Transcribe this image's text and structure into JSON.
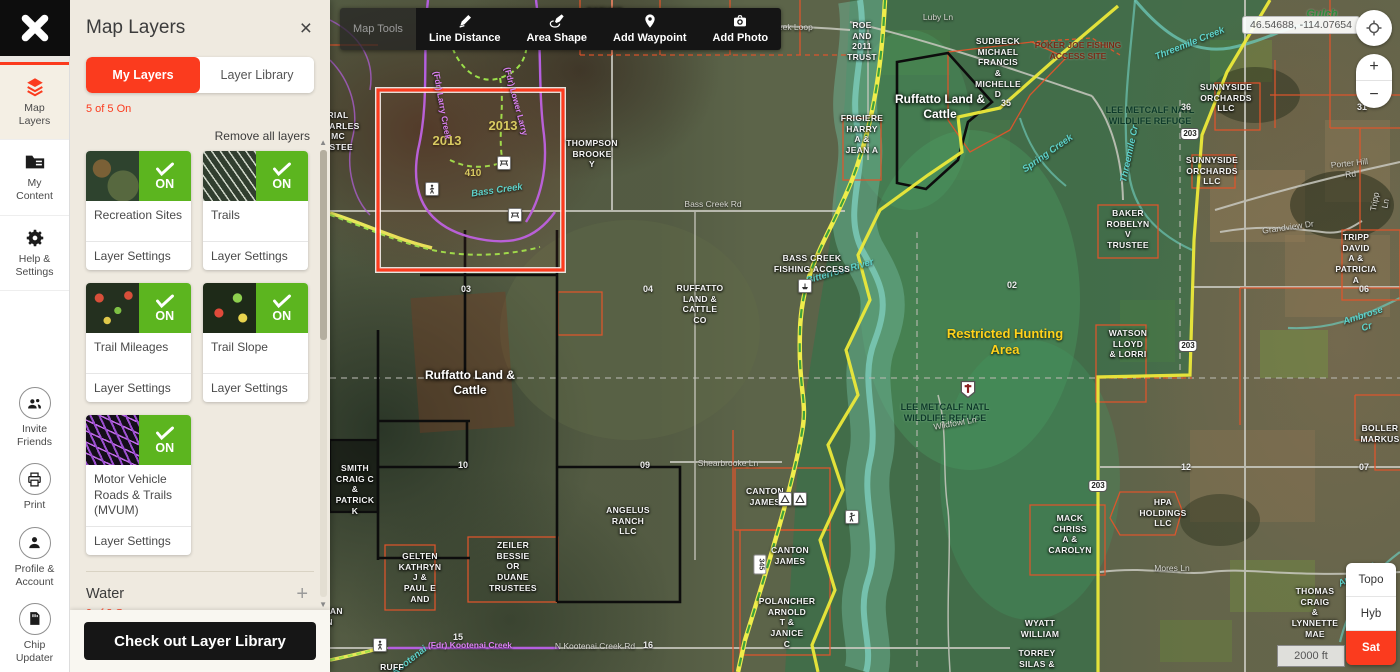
{
  "sidebar": {
    "items": [
      {
        "label": "Map\nLayers",
        "icon": "map-layers-icon",
        "active": true
      },
      {
        "label": "My\nContent",
        "icon": "folder-icon",
        "active": false
      },
      {
        "label": "Help &\nSettings",
        "icon": "gear-icon",
        "active": false
      },
      {
        "label": "Invite\nFriends",
        "icon": "people-icon",
        "active": false
      },
      {
        "label": "Print",
        "icon": "printer-icon",
        "active": false
      },
      {
        "label": "Profile &\nAccount",
        "icon": "person-icon",
        "active": false
      },
      {
        "label": "Chip\nUpdater",
        "icon": "chip-icon",
        "active": false
      }
    ]
  },
  "panel": {
    "title": "Map Layers",
    "close_label": "×",
    "tabs": [
      {
        "label": "My Layers"
      },
      {
        "label": "Layer Library"
      }
    ],
    "status": "5 of 5 On",
    "remove_all": "Remove all layers",
    "cards": [
      {
        "name": "Recreation Sites",
        "status": "ON",
        "settings": "Layer Settings"
      },
      {
        "name": "Trails",
        "status": "ON",
        "settings": "Layer Settings"
      },
      {
        "name": "Trail Mileages",
        "status": "ON",
        "settings": "Layer Settings"
      },
      {
        "name": "Trail Slope",
        "status": "ON",
        "settings": "Layer Settings"
      },
      {
        "name": "Motor Vehicle Roads & Trails (MVUM)",
        "status": "ON",
        "settings": "Layer Settings"
      }
    ],
    "water": {
      "title": "Water",
      "status": "0 of 3 On",
      "add": "+"
    },
    "cta": "Check out Layer Library"
  },
  "map_tools": {
    "title": "Map Tools",
    "buttons": [
      {
        "label": "Line Distance",
        "icon": "pencil-line-icon"
      },
      {
        "label": "Area Shape",
        "icon": "pencil-shape-icon"
      },
      {
        "label": "Add Waypoint",
        "icon": "map-pin-icon"
      },
      {
        "label": "Add Photo",
        "icon": "camera-icon"
      }
    ]
  },
  "controls": {
    "coordinates": "46.54688, -114.07654",
    "zoom_in": "+",
    "zoom_out": "−",
    "scale": "2000 ft",
    "basemaps": [
      {
        "label": "Topo",
        "active": false
      },
      {
        "label": "Hyb",
        "active": false
      },
      {
        "label": "Sat",
        "active": true
      }
    ]
  },
  "map_labels": [
    {
      "t": "ESTHER",
      "c": "owner",
      "x": 275,
      "y": 6
    },
    {
      "t": "Larry Creek Loop",
      "c": "road",
      "x": 450,
      "y": 22
    },
    {
      "t": "Luby Ln",
      "c": "road",
      "x": 608,
      "y": 12
    },
    {
      "t": "ROE\nAND\n2011\nTRUST",
      "c": "owner",
      "x": 532,
      "y": 20
    },
    {
      "t": "SUDBECK\nMICHAEL\nFRANCIS\n&\nMICHELLE\nD",
      "c": "owner",
      "x": 668,
      "y": 36
    },
    {
      "t": "POKER JOE FISHING\nACCESS SITE",
      "c": "poi-dark",
      "x": 748,
      "y": 40
    },
    {
      "t": "Ruffatto Land &\nCattle",
      "c": "owner-lg",
      "x": 610,
      "y": 92
    },
    {
      "t": "LEE METCALF NATL\nWILDLIFE REFUGE",
      "c": "forest",
      "x": 820,
      "y": 105
    },
    {
      "t": "SUNNYSIDE\nORCHARDS\nLLC",
      "c": "owner",
      "x": 896,
      "y": 82
    },
    {
      "t": "SUNNYSIDE\nORCHARDS\nLLC",
      "c": "owner",
      "x": 882,
      "y": 155
    },
    {
      "t": "BAKER\nROBELYN\nV\nTRUSTEE",
      "c": "owner",
      "x": 798,
      "y": 208
    },
    {
      "t": "TRIPP\nDAVID\nA &\nPATRICIA\nA",
      "c": "owner",
      "x": 1026,
      "y": 232
    },
    {
      "t": "THOMPSON\nBROOKE\nY",
      "c": "owner",
      "x": 262,
      "y": 138
    },
    {
      "t": "FRIGIERE\nHARRY\nA &\nJEAN A",
      "c": "owner",
      "x": 532,
      "y": 113
    },
    {
      "t": "RIAL\nCHARLES\nMC\nUSTEE",
      "c": "owner",
      "x": 8,
      "y": 110
    },
    {
      "t": "2013",
      "c": "year",
      "x": 117,
      "y": 133
    },
    {
      "t": "2013",
      "c": "year",
      "x": 173,
      "y": 118
    },
    {
      "t": "410",
      "c": "year",
      "x": 143,
      "y": 168,
      "fs": 10
    },
    {
      "t": "Bass Creek",
      "c": "water",
      "x": 167,
      "y": 185,
      "r": -8
    },
    {
      "t": "(Fdr) Larry Creek",
      "c": "purple",
      "x": 112,
      "y": 100,
      "r": 80
    },
    {
      "t": "(Fdr) Lower Larry",
      "c": "purple",
      "x": 186,
      "y": 96,
      "r": 75
    },
    {
      "t": "Bass Creek Rd",
      "c": "road",
      "x": 383,
      "y": 199
    },
    {
      "t": "RUFFATTO\nLAND &\nCATTLE\nCO",
      "c": "owner",
      "x": 370,
      "y": 283
    },
    {
      "t": "04",
      "c": "section",
      "x": 318,
      "y": 284
    },
    {
      "t": "03",
      "c": "section",
      "x": 136,
      "y": 284
    },
    {
      "t": "Ruffatto Land &\nCattle",
      "c": "owner-lg",
      "x": 140,
      "y": 368
    },
    {
      "t": "SMITH\nCRAIG C\n&\nPATRICK\nK",
      "c": "owner",
      "x": 25,
      "y": 463
    },
    {
      "t": "GELTEN\nKATHRYN\nJ &\nPAUL E\nAND",
      "c": "owner",
      "x": 90,
      "y": 551
    },
    {
      "t": "CHAPMAN\nOREN",
      "c": "owner",
      "x": -10,
      "y": 606
    },
    {
      "t": "ZEILER\nBESSIE\nOR\nDUANE\nTRUSTEES",
      "c": "owner",
      "x": 183,
      "y": 540
    },
    {
      "t": "ANGELUS\nRANCH\nLLC",
      "c": "owner",
      "x": 298,
      "y": 505
    },
    {
      "t": "CANTON\nJAMES",
      "c": "owner",
      "x": 435,
      "y": 486
    },
    {
      "t": "CANTON\nJAMES",
      "c": "owner",
      "x": 460,
      "y": 545
    },
    {
      "t": "POLANCHER\nARNOLD\nT &\nJANICE\nC",
      "c": "owner",
      "x": 457,
      "y": 596
    },
    {
      "t": "TORREY\nSILAS &",
      "c": "owner",
      "x": 707,
      "y": 648
    },
    {
      "t": "WYATT\nWILLIAM",
      "c": "owner",
      "x": 710,
      "y": 618
    },
    {
      "t": "Shearbrooke Ln",
      "c": "road",
      "x": 398,
      "y": 458
    },
    {
      "t": "(Fdr) Kootenai Creek",
      "c": "purple",
      "x": 140,
      "y": 640
    },
    {
      "t": "N Kootenai Creek Rd",
      "c": "road",
      "x": 265,
      "y": 641
    },
    {
      "t": "Kootenai",
      "c": "water",
      "x": 80,
      "y": 655,
      "r": -38
    },
    {
      "t": "RUFF",
      "c": "owner",
      "x": 62,
      "y": 662
    },
    {
      "t": "Bitterroot  River",
      "c": "water",
      "x": 510,
      "y": 266,
      "r": -16
    },
    {
      "t": "BASS CREEK\nFISHING ACCESS",
      "c": "owner",
      "x": 482,
      "y": 253
    },
    {
      "t": "Restricted Hunting\nArea",
      "c": "restrict",
      "x": 675,
      "y": 326
    },
    {
      "t": "02",
      "c": "section",
      "x": 682,
      "y": 280
    },
    {
      "t": "LEE METCALF NATL\nWILDLIFE REFUGE",
      "c": "forest",
      "x": 615,
      "y": 402
    },
    {
      "t": "Wildfowl Ln",
      "c": "road",
      "x": 625,
      "y": 418,
      "r": -10
    },
    {
      "t": "WATSON\nLLOYD\n& LORRI",
      "c": "owner",
      "x": 798,
      "y": 328
    },
    {
      "t": "Threemile Creek",
      "c": "water",
      "x": 860,
      "y": 38,
      "r": -22
    },
    {
      "t": "Threemile Cr",
      "c": "water",
      "x": 800,
      "y": 148,
      "r": -78
    },
    {
      "t": "Spring Creek",
      "c": "water",
      "x": 718,
      "y": 148,
      "r": -35
    },
    {
      "t": "Gulch",
      "c": "green",
      "x": 992,
      "y": 8
    },
    {
      "t": "Ambrose Cr",
      "c": "water",
      "x": 1035,
      "y": 310,
      "r": -18
    },
    {
      "t": "Ambrose Creek",
      "c": "water",
      "x": 1030,
      "y": 568,
      "r": -30
    },
    {
      "t": "Porter Hill Rd",
      "c": "road",
      "x": 1020,
      "y": 158,
      "r": -6
    },
    {
      "t": "Grandview Dr",
      "c": "road",
      "x": 958,
      "y": 222,
      "r": -8
    },
    {
      "t": "Tripp Ln",
      "c": "road",
      "x": 1050,
      "y": 192,
      "r": -80
    },
    {
      "t": "Mores Ln",
      "c": "road",
      "x": 842,
      "y": 563
    },
    {
      "t": "BOLLER\nMARKUS",
      "c": "owner",
      "x": 1050,
      "y": 423
    },
    {
      "t": "HPA\nHOLDINGS\nLLC",
      "c": "owner",
      "x": 833,
      "y": 497
    },
    {
      "t": "MACK\nCHRISS\nA &\nCAROLYN",
      "c": "owner",
      "x": 740,
      "y": 513
    },
    {
      "t": "THOMAS\nCRAIG\n&\nLYNNETTE\nMAE",
      "c": "owner",
      "x": 985,
      "y": 586
    },
    {
      "t": "36",
      "c": "section",
      "x": 856,
      "y": 102
    },
    {
      "t": "31",
      "c": "section",
      "x": 1032,
      "y": 102
    },
    {
      "t": "35",
      "c": "section",
      "x": 676,
      "y": 98
    },
    {
      "t": "06",
      "c": "section",
      "x": 1034,
      "y": 284
    },
    {
      "t": "07",
      "c": "section",
      "x": 1034,
      "y": 462
    },
    {
      "t": "12",
      "c": "section",
      "x": 856,
      "y": 462
    },
    {
      "t": "09",
      "c": "section",
      "x": 315,
      "y": 460
    },
    {
      "t": "10",
      "c": "section",
      "x": 133,
      "y": 460
    },
    {
      "t": "15",
      "c": "section",
      "x": 128,
      "y": 632
    },
    {
      "t": "16",
      "c": "section",
      "x": 318,
      "y": 640
    },
    {
      "t": "345",
      "c": "badge",
      "x": 430,
      "y": 558,
      "r": 90
    },
    {
      "t": "203",
      "c": "shield",
      "x": 860,
      "y": 128
    },
    {
      "t": "203",
      "c": "shield",
      "x": 858,
      "y": 340
    },
    {
      "t": "203",
      "c": "shield",
      "x": 768,
      "y": 480
    }
  ],
  "map_markers": [
    {
      "icon": "picnic-table-icon",
      "x": 167,
      "y": 156
    },
    {
      "icon": "picnic-table-icon",
      "x": 178,
      "y": 208
    },
    {
      "icon": "hiker-icon",
      "x": 95,
      "y": 182
    },
    {
      "icon": "hiker-icon",
      "x": 43,
      "y": 638
    },
    {
      "icon": "hunter-icon",
      "x": 515,
      "y": 510
    },
    {
      "icon": "boat-ramp-icon",
      "x": 468,
      "y": 279
    },
    {
      "icon": "camp-icon",
      "x": 448,
      "y": 492
    },
    {
      "icon": "camp-icon",
      "x": 463,
      "y": 492
    },
    {
      "icon": "restricted-shield-icon",
      "x": 630,
      "y": 380
    }
  ]
}
